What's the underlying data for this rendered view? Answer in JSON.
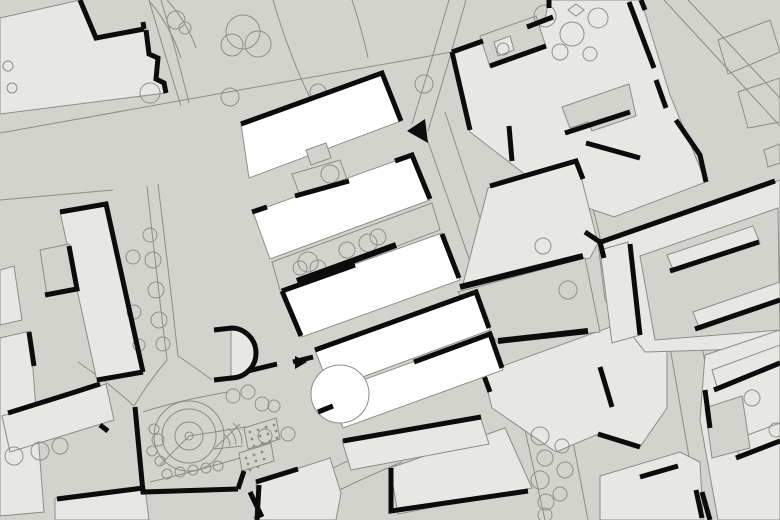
{
  "palette": {
    "background": "#d3d3ce",
    "building": "#e7e7e3",
    "highlight": "#ffffff",
    "wall": "#0c0c0c",
    "line": "#8d8d88",
    "tree_line": "#90908b"
  },
  "map": {
    "type": "architectural-site-plan",
    "style": "figure-ground",
    "highlight_complex": {
      "bars": 5,
      "fill": "#ffffff",
      "has_circular_annex": true,
      "marker": {
        "shape": "triangle",
        "fill": "#0c0c0c",
        "points": "west"
      }
    },
    "symbols": {
      "tree": "thin-outlined circle",
      "wall": "thick black line",
      "building": "light grey mass",
      "path": "thin grey line"
    }
  }
}
